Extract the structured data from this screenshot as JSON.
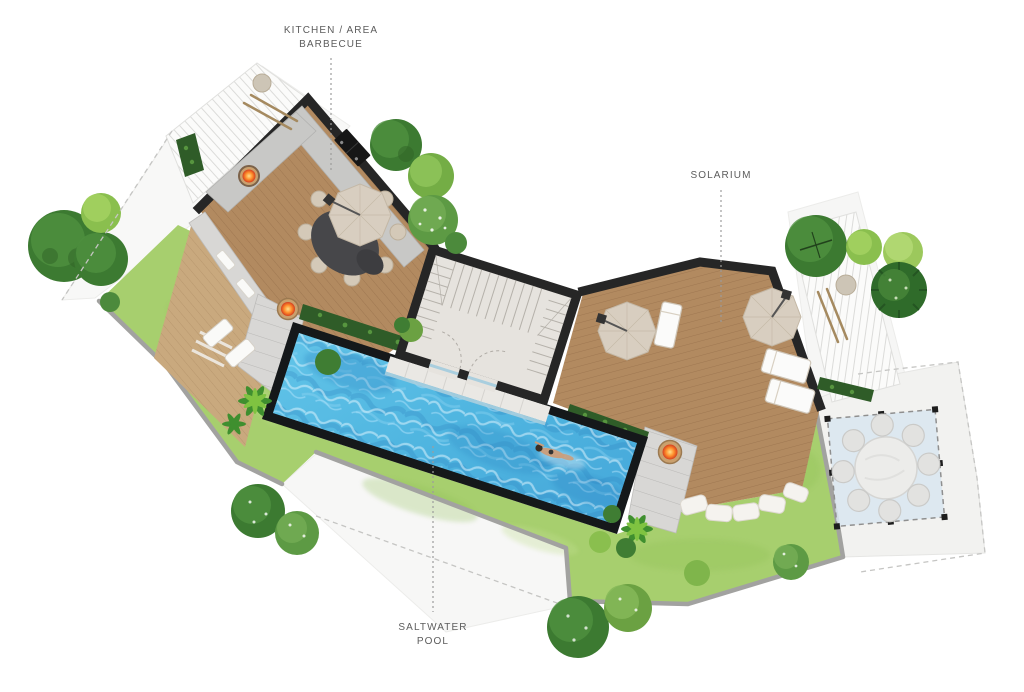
{
  "labels": {
    "kitchen_barbecue": {
      "line1": "KITCHEN / AREA",
      "line2": "BARBECUE"
    },
    "solarium": {
      "line1": "SOLARIUM"
    },
    "saltwater_pool": {
      "line1": "SALTWATER",
      "line2": "POOL"
    }
  },
  "colors": {
    "lawn": "#a7cf6e",
    "pool_water": "#4fb5e0",
    "wood_deck": "#b28a60",
    "wall": "#262626",
    "pave": "#f2f2f0",
    "glass": "#d9e6f0",
    "label_text": "#5c5c5c"
  }
}
